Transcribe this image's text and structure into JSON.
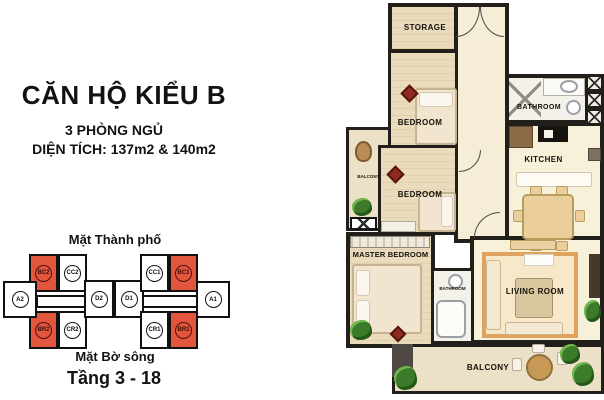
{
  "header": {
    "title": "CĂN HỘ KIỂU B",
    "bedrooms_line": "3 PHÒNG NGỦ",
    "area_line": "DIỆN TÍCH: 137m2 & 140m2"
  },
  "key_plan": {
    "city_side_label": "Mặt Thành phố",
    "river_side_label": "Mặt Bờ sông",
    "floors_label": "Tầng 3 - 18",
    "highlight_color": "#e2563e",
    "units": {
      "a2": "A2",
      "bc2": "BC2",
      "cc2": "CC2",
      "br2": "BR2",
      "cr2": "CR2",
      "d2": "D2",
      "d1": "D1",
      "cc1": "CC1",
      "bc1": "BC1",
      "cr1": "CR1",
      "br1": "BR1",
      "a1": "A1"
    }
  },
  "floorplan": {
    "storage": "STORAGE",
    "bedroom1": "BEDROOM",
    "bedroom2": "BEDROOM",
    "master_bedroom": "MASTER BEDROOM",
    "bathroom1": "BATHROOM",
    "bathroom2": "BATHROOM",
    "kitchen": "KITCHEN",
    "living_room": "LIVING ROOM",
    "balcony_left": "BALCONY",
    "balcony_bottom": "BALCONY"
  },
  "colors": {
    "wall": "#221f1b",
    "wood_floor": "#e6d7b6",
    "tile_floor": "#f8f1da",
    "balcony_floor": "#ece0c6",
    "rug_accent": "#dfa35f",
    "carpet_red": "#8d2b1e",
    "plant_green": "#3c7b2a"
  }
}
